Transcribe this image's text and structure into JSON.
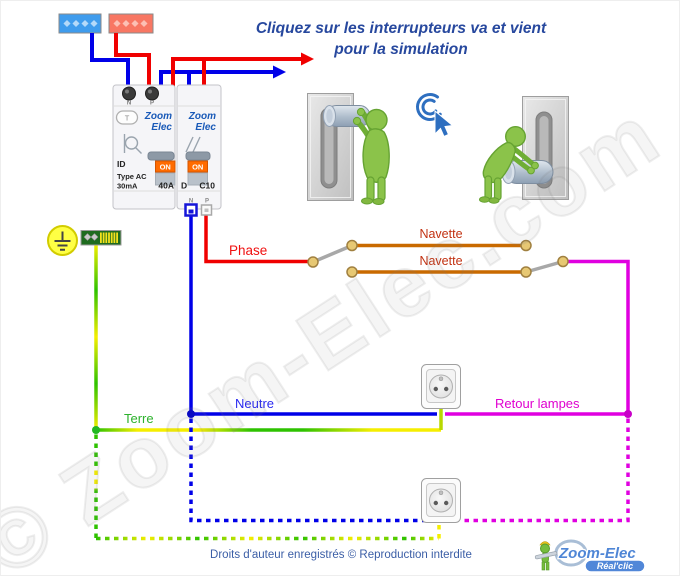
{
  "title": {
    "line1": "Cliquez sur les interrupteurs va et vient",
    "line2": "pour la simulation"
  },
  "breaker_panel": {
    "brand_line1": "Zoom",
    "brand_line2": "Elec",
    "differential": {
      "test_button": "T",
      "on_label": "ON",
      "id": "ID",
      "type": "Type AC",
      "sensitivity": "30mA",
      "rating": "40A",
      "terminal_n": "N",
      "terminal_p": "P"
    },
    "breaker": {
      "on_label": "ON",
      "curve": "D",
      "rating": "C10",
      "terminal_n": "N",
      "terminal_p": "P"
    }
  },
  "wire_labels": {
    "phase": "Phase",
    "navette_top": "Navette",
    "navette_bottom": "Navette",
    "neutre": "Neutre",
    "terre": "Terre",
    "retour_lampes": "Retour lampes"
  },
  "colors": {
    "phase": "#f00000",
    "neutre": "#0000e8",
    "terre_green": "#2ec200",
    "terre_yellow": "#f5ee00",
    "navette": "#c96a00",
    "retour_lampes": "#e000e0",
    "title_blue": "#27489e"
  },
  "watermark": "© Zoom-Elec.com",
  "footer": {
    "copyright": "Droits d'auteur enregistrés © Reproduction interdite"
  },
  "logo": {
    "name": "Zoom-Elec",
    "tagline": "Réal'clic"
  }
}
